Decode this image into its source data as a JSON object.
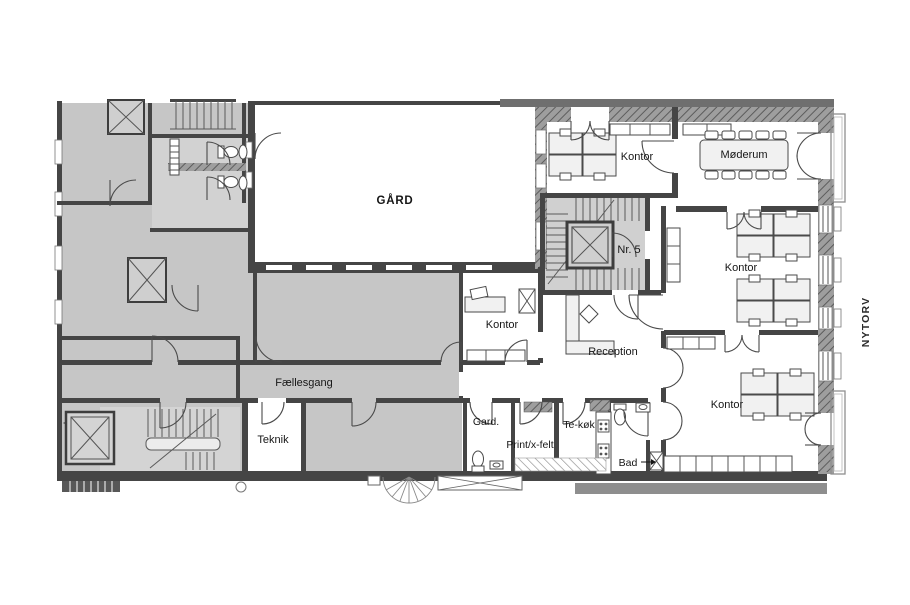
{
  "drawing": {
    "street_label": "NYTORV",
    "labels": {
      "gaard": "GÅRD",
      "kontor_nw": "Kontor",
      "moederum": "Møderum",
      "nr5": "Nr. 5",
      "kontor_e": "Kontor",
      "kontor_mid": "Kontor",
      "reception": "Reception",
      "faellesgang": "Fællesgang",
      "teknik": "Teknik",
      "garderobe": "Gard.",
      "print": "Print/x-felt",
      "tekoek": "Te-køk",
      "bad": "Bad",
      "kontor_s": "Kontor"
    },
    "colors": {
      "background": "#ffffff",
      "neighbor_fill": "#c6c6c6",
      "stair_fill": "#d2d2d2",
      "wall": "#454545",
      "wall_light": "#6f6f6f",
      "facade": "#9c9c9c",
      "furniture": "#f1f1f1",
      "sidewalk": "#8e8e8e"
    }
  }
}
